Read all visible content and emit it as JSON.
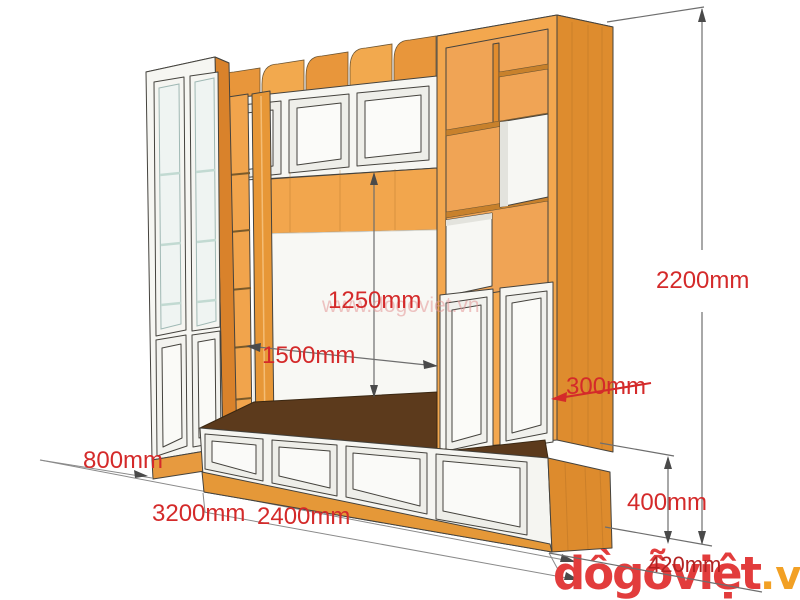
{
  "diagram": {
    "type": "furniture-dimension-diagram",
    "subject": "wooden TV wall unit cabinet, 3D perspective view with dimension callouts",
    "annotations": {
      "niche_height": "1250mm",
      "niche_width": "1500mm",
      "overall_height": "2200mm",
      "top_cabinet_depth": "300mm",
      "side_return_depth": "800mm",
      "overall_width": "3200mm",
      "tv_bench_width": "2400mm",
      "tv_bench_height": "400mm",
      "tv_bench_depth": "420mm"
    },
    "colors": {
      "dimension_text": "#d42a2a",
      "wood_front": "#f2a64d",
      "wood_side": "#de8c2e",
      "bench_top_shadow": "#5c3a1c",
      "panel_white": "#f6f6f2"
    }
  },
  "watermark": {
    "text": "www.dogoviet.vn"
  },
  "logo": {
    "main": "dồgỗviệt",
    "tld": ".vn"
  }
}
